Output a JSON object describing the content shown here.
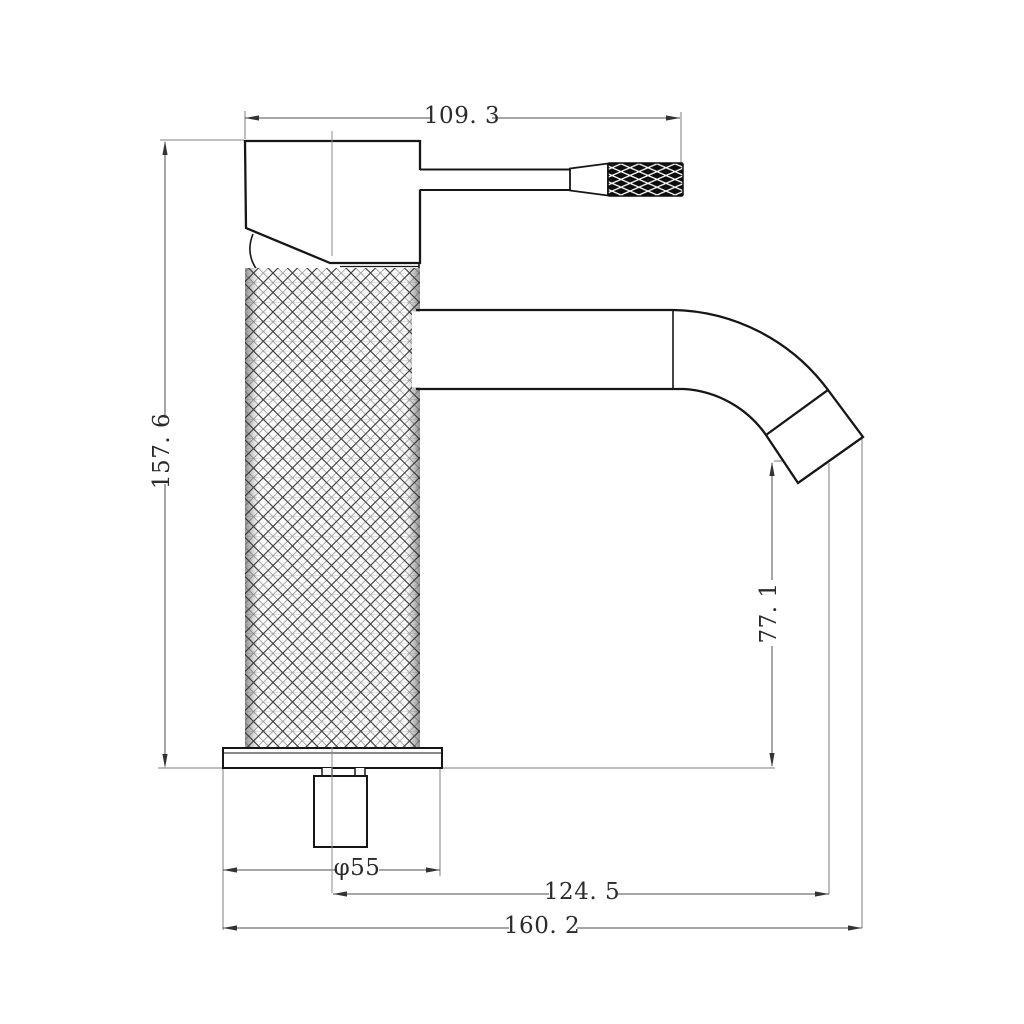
{
  "drawing": {
    "kind": "technical-drawing",
    "subject": "single-lever basin mixer tap, side elevation with knurled body",
    "background": "#ffffff"
  },
  "dimensions": {
    "handle_width": {
      "label": "109. 3",
      "value": 109.3,
      "orientation": "horizontal",
      "location": "top"
    },
    "overall_height": {
      "label": "157. 6",
      "value": 157.6,
      "orientation": "vertical",
      "location": "left"
    },
    "spout_outlet_height": {
      "label": "77. 1",
      "value": 77.1,
      "orientation": "vertical",
      "location": "right"
    },
    "base_diameter": {
      "label": "φ55",
      "value": 55,
      "orientation": "horizontal",
      "location": "bottom",
      "prefix": "φ"
    },
    "spout_reach_from_center": {
      "label": "124. 5",
      "value": 124.5,
      "orientation": "horizontal",
      "location": "bottom"
    },
    "overall_reach": {
      "label": "160. 2",
      "value": 160.2,
      "orientation": "horizontal",
      "location": "bottom"
    }
  },
  "colors": {
    "outline": "#161616",
    "dimension_line": "#4d4d4d",
    "construction_line": "#8c8c8c",
    "text": "#2b2b2b",
    "grip_fill": "#0c0c0c",
    "background": "#ffffff"
  }
}
